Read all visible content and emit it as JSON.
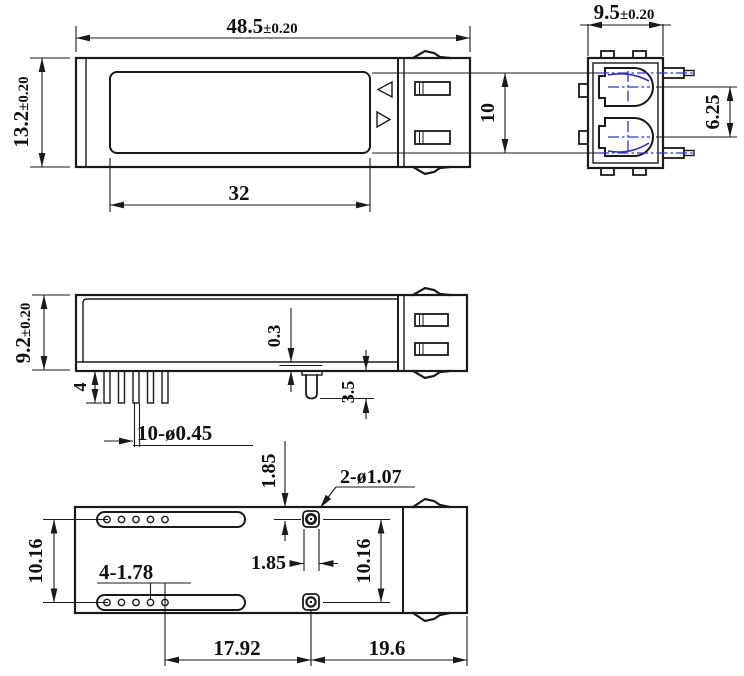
{
  "views": {
    "top": {
      "dims": {
        "overall_width": {
          "value": "48.5",
          "tol": "±0.20"
        },
        "overall_height": {
          "value": "13.2",
          "tol": "±0.20"
        },
        "label_width": {
          "value": "32"
        },
        "pin_pitch": {
          "value": "10"
        }
      }
    },
    "end": {
      "dims": {
        "overall_width": {
          "value": "9.5",
          "tol": "±0.20"
        },
        "port_pitch": {
          "value": "6.25"
        }
      }
    },
    "side": {
      "dims": {
        "overall_height": {
          "value": "9.2",
          "tol": "±0.20"
        },
        "pin_length": {
          "value": "4"
        },
        "pin_spec": {
          "value": "10-ø0.45"
        },
        "step_height": {
          "value": "0.3"
        },
        "post_length": {
          "value": "3.5"
        }
      }
    },
    "bottom": {
      "dims": {
        "slot_pitch": {
          "value": "10.16"
        },
        "hole_spec": {
          "value": "4-1.78"
        },
        "post_edge_offset": {
          "value": "1.85"
        },
        "post_width": {
          "value": "1.85"
        },
        "post_hole_spec": {
          "value": "2-ø1.07"
        },
        "post_pitch": {
          "value": "10.16"
        },
        "hole_to_post": {
          "value": "17.92"
        },
        "post_to_end": {
          "value": "19.6"
        }
      }
    }
  },
  "colors": {
    "line": "#1a1a1a",
    "centerline": "#3333bb",
    "background": "#ffffff"
  }
}
